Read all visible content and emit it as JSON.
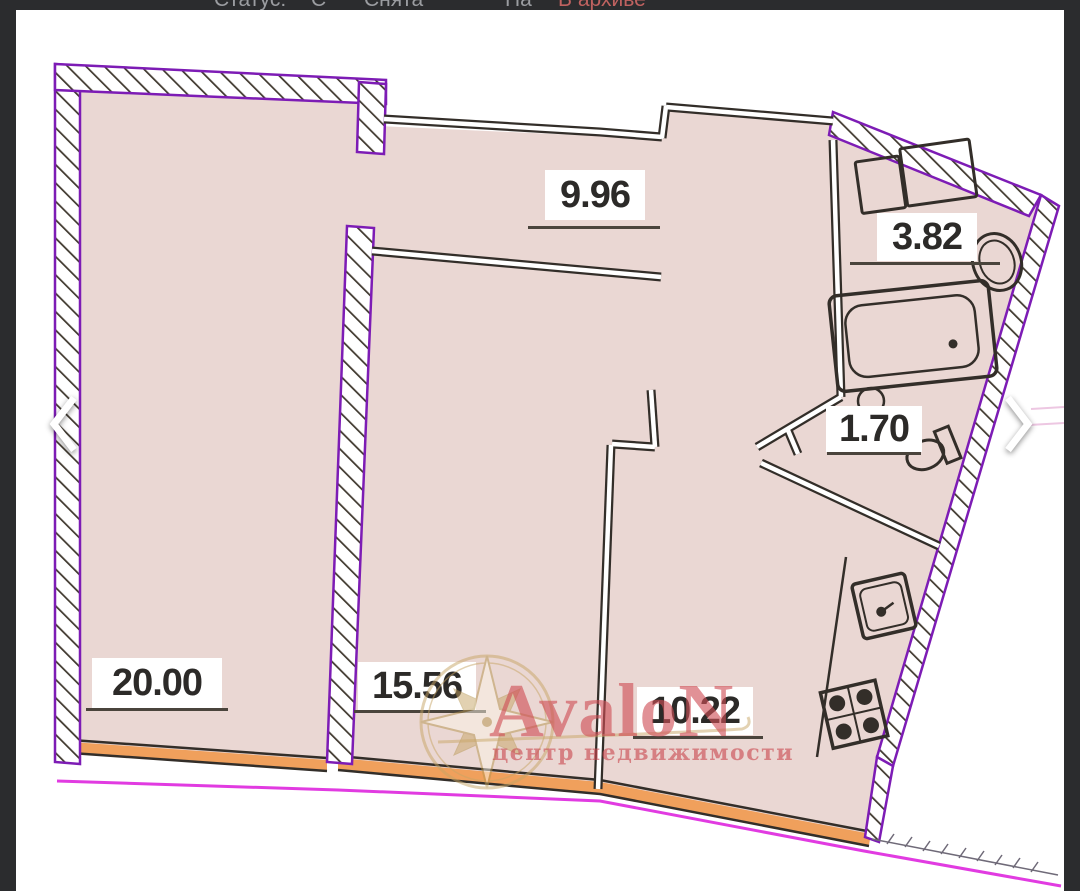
{
  "status_bar": {
    "items": [
      {
        "label": "Статус:"
      },
      {
        "label": "С"
      },
      {
        "label": "Снята"
      },
      {
        "label": "На"
      },
      {
        "label": "В архиве"
      }
    ],
    "archive_color": "#c06260"
  },
  "gallery": {
    "prev_label": "previous image",
    "next_label": "next image"
  },
  "floorplan": {
    "type": "apartment floor plan",
    "rooms": [
      {
        "id": "living-room",
        "area": "20.00"
      },
      {
        "id": "bedroom",
        "area": "15.56"
      },
      {
        "id": "hall",
        "area": "9.96"
      },
      {
        "id": "kitchen",
        "area": "10.22"
      },
      {
        "id": "bathroom",
        "area": "3.82"
      },
      {
        "id": "wc",
        "area": "1.70"
      }
    ],
    "colors": {
      "floor_fill": "#ead7d3",
      "wall_purple": "#7d1cb5",
      "wall_dark": "#332e29",
      "window_orange": "#f0a05c",
      "boundary_magenta": "#de26de"
    }
  },
  "watermark": {
    "brand": "AvaloN",
    "tagline": "центр недвижимости",
    "brand_color": "#cf4e55",
    "gold_color": "#c7a565"
  }
}
